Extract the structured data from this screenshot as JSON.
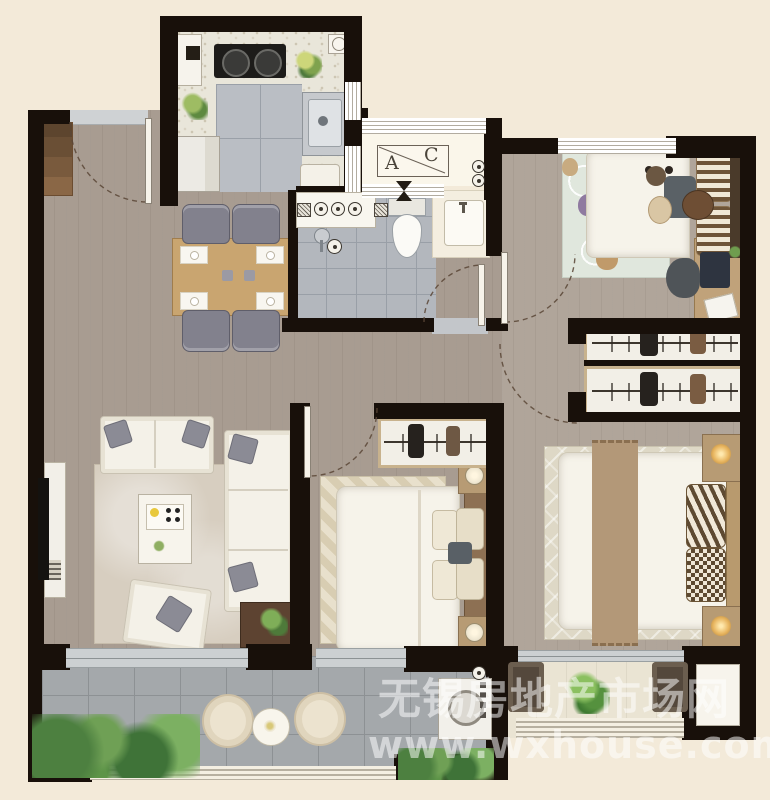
{
  "watermark": {
    "line1": "无锡房地产市场网",
    "line2": "www.wxhouse.com"
  },
  "ac_platform": {
    "letter_a": "A",
    "letter_c": "C"
  },
  "palette": {
    "background": "#f3ead9",
    "wall": "#18100a",
    "wood_floor": "#a89c91",
    "wood_floor_light": "#b0a59a",
    "kitchen_terrazzo": "#e9e6da",
    "bath_tile": "#b3b7bd",
    "balcony_tile": "#a4a8ab",
    "balcony_stone": "#eae4d3",
    "kids_rug": "#e0e7dd",
    "accent_green": "#6a9a52",
    "table_wood": "#c9a570",
    "walnut": "#5d4331",
    "headboard_brown": "#8d7053"
  },
  "rooms": [
    {
      "name": "kitchen",
      "furniture": [
        "cabinet",
        "gas-stove",
        "sink",
        "refrigerator",
        "cutting-board",
        "herb-plant"
      ]
    },
    {
      "name": "entry-dining",
      "furniture": [
        "shoe-cabinet",
        "dining-table",
        "dining-chairs-x4"
      ]
    },
    {
      "name": "ac-platform",
      "furniture": [
        "ac-outdoor-unit"
      ]
    },
    {
      "name": "bathroom",
      "furniture": [
        "vanity",
        "shower-head",
        "toilet",
        "floor-drain",
        "wash-basin"
      ]
    },
    {
      "name": "kids-bedroom",
      "furniture": [
        "single-bed",
        "teddy-bear",
        "hot-air-balloon-rug",
        "desk",
        "desk-chair",
        "monitor"
      ]
    },
    {
      "name": "living-room",
      "furniture": [
        "tv",
        "tv-console",
        "sofa",
        "chaise-sofa",
        "armchair",
        "coffee-table",
        "side-table",
        "rug"
      ]
    },
    {
      "name": "middle-bedroom",
      "furniture": [
        "wardrobe",
        "double-bed",
        "nightstands-x2",
        "chevron-rug"
      ]
    },
    {
      "name": "master-bedroom",
      "furniture": [
        "wardrobes-x2",
        "double-bed",
        "nightstands-x2",
        "rug"
      ]
    },
    {
      "name": "laundry-balcony",
      "furniture": [
        "washing-machine",
        "round-chairs-x2",
        "round-table",
        "shrubs"
      ]
    },
    {
      "name": "rear-balcony",
      "furniture": [
        "lounge-chairs-x2",
        "potted-plant"
      ]
    }
  ]
}
